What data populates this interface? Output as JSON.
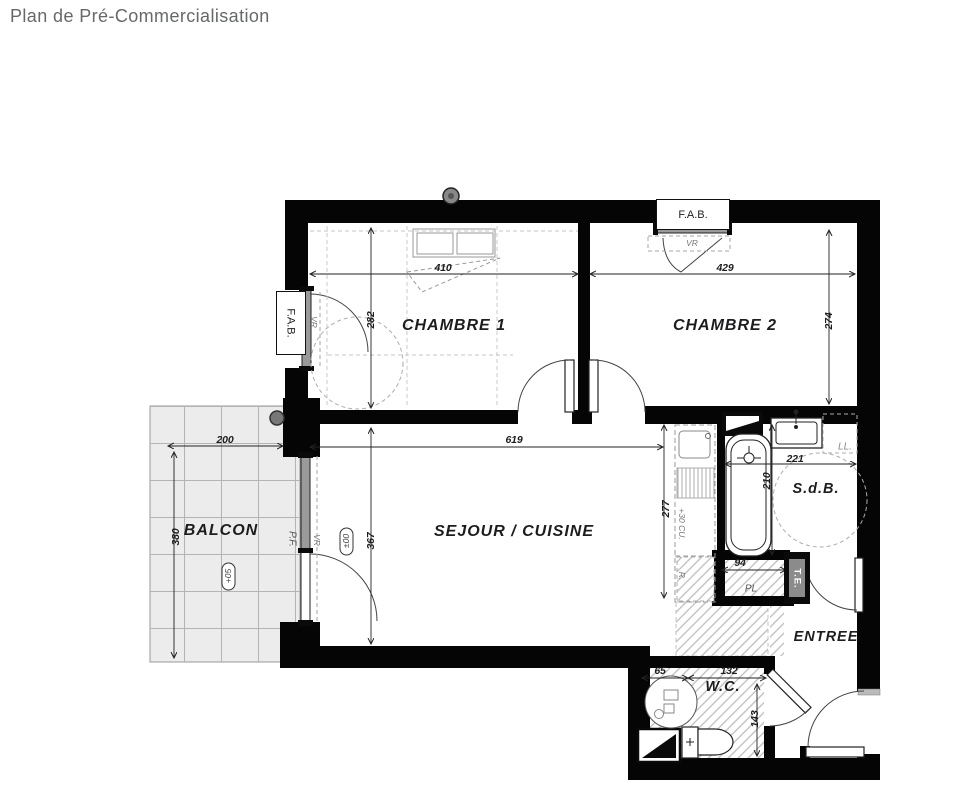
{
  "title": "Plan de Pré-Commercialisation",
  "rooms": {
    "chambre1": "CHAMBRE 1",
    "chambre2": "CHAMBRE 2",
    "sejour": "SEJOUR / CUISINE",
    "balcon": "BALCON",
    "sdb": "S.d.B.",
    "entree": "ENTREE",
    "wc": "W.C."
  },
  "dims": {
    "d410": "410",
    "d429": "429",
    "d282": "282",
    "d274": "274",
    "d200": "200",
    "d380": "380",
    "d619": "619",
    "d367": "367",
    "d277": "277",
    "d221": "221",
    "d210": "210",
    "d94": "94",
    "d65": "65",
    "d132": "132",
    "d143": "143"
  },
  "annotations": {
    "fab_top": "F.A.B.",
    "fab_left": "F.A.B.",
    "vr_top": "VR",
    "vr_left": "VR",
    "vr_pf": "VR",
    "pf": "P.F.",
    "ll": "LL.",
    "te": "T.E.",
    "pl": "PL",
    "kitchen_counter": "+30 CU.",
    "fridge": "R.",
    "level_sejour": "±00",
    "level_balcon": "+05"
  },
  "colors": {
    "wall": "#050505",
    "label": "#1d1d1f",
    "title": "#66686a",
    "dash": "#a6a6a6"
  }
}
